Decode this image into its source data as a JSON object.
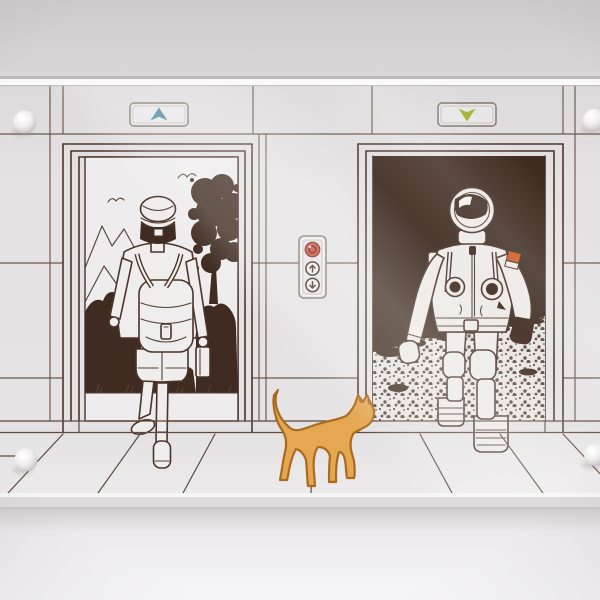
{
  "photo": {
    "subject": "elevator wall decal behind acrylic glass panel",
    "left_door_scene": "boy with backpack walking into nature scene",
    "right_door_scene": "astronaut stepping out of moon scene",
    "between_doors": "elevator call button panel",
    "foreground": "orange cat walking toward right door"
  },
  "icons": {
    "up_indicator": "up-arrow-icon",
    "down_indicator": "down-arrow-icon",
    "call_up": "up-arrow-icon",
    "call_down": "down-arrow-icon",
    "alarm": "round-light-icon",
    "screw": "standoff-screw-icon",
    "birds": "bird-icon"
  },
  "colors": {
    "line": "#4a342b",
    "dark": "#3f2b21",
    "wall": "#e4e1e2",
    "scene_bg": "#eeecec",
    "moon_bg": "#e8e4e1",
    "suit": "#edeae7",
    "cat_fill": "#e5a751",
    "cat_outline": "#aa6b1e",
    "up_arrow": "#4d87a0",
    "down_arrow": "#a5b233",
    "call_red": "#cc4a33",
    "call_red_dark": "#7e2317",
    "call_glint": "#f3d9d0",
    "flag_orange": "#cf5520",
    "flag_white": "#efece9"
  }
}
